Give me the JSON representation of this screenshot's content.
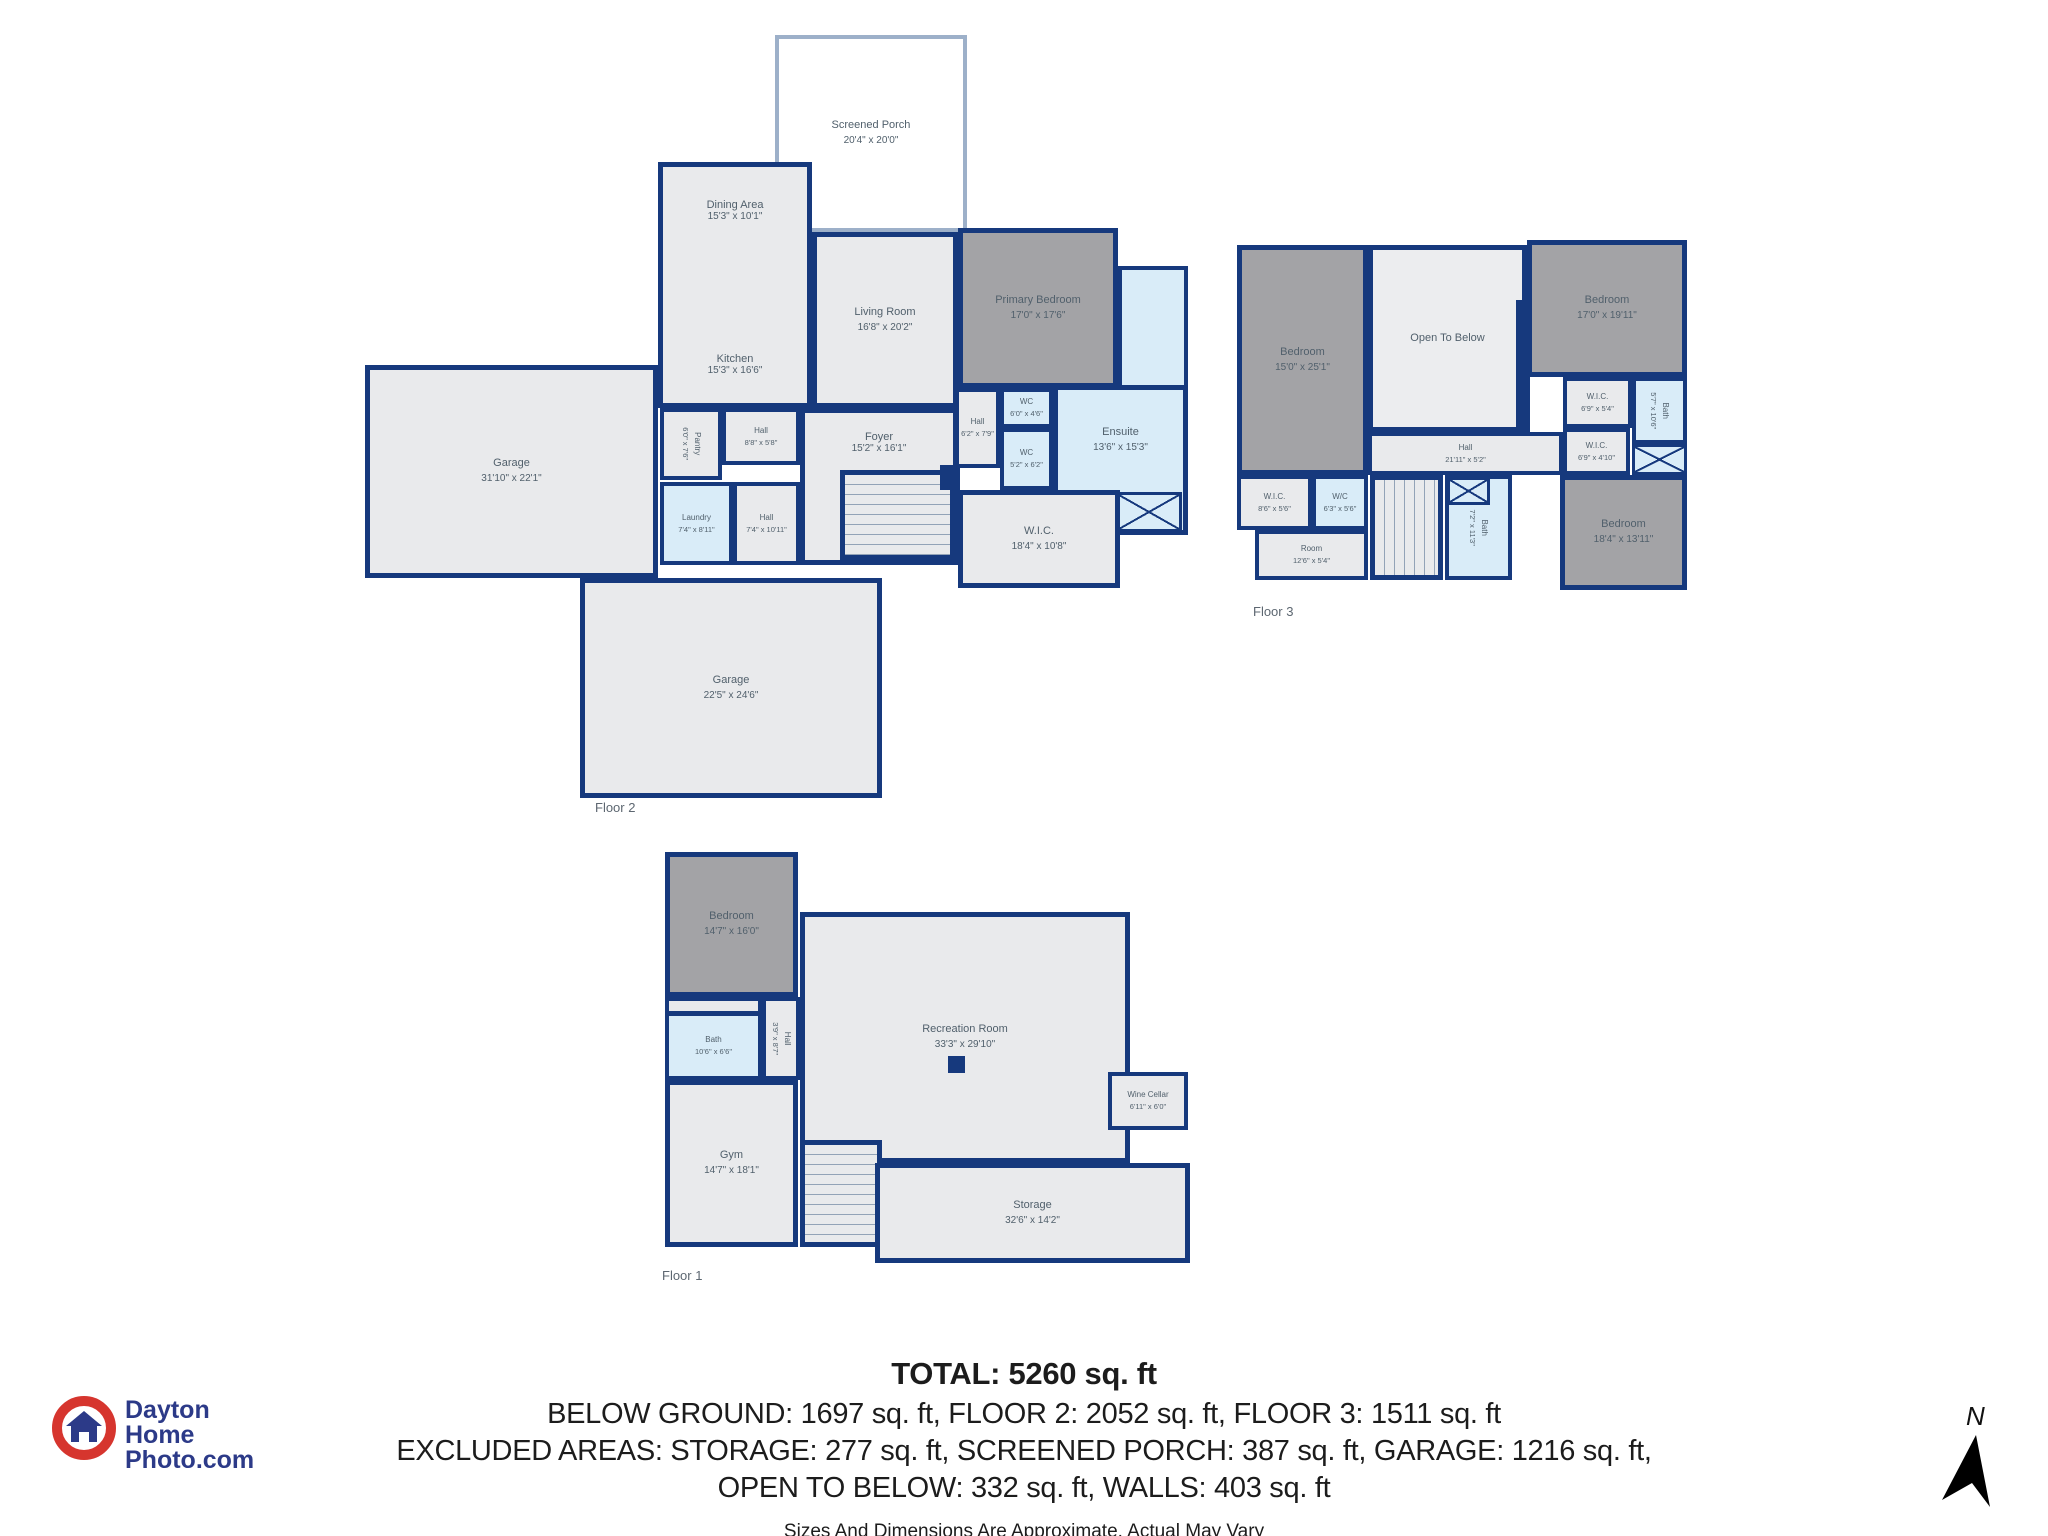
{
  "branding": {
    "line1": "Dayton",
    "line2": "Home",
    "line3": "Photo.com"
  },
  "compass": {
    "label": "N"
  },
  "summary": {
    "total": "TOTAL: 5260 sq. ft",
    "line1": "BELOW GROUND: 1697 sq. ft, FLOOR 2: 2052 sq. ft, FLOOR 3: 1511 sq. ft",
    "line2": "EXCLUDED AREAS: STORAGE: 277 sq. ft, SCREENED PORCH: 387 sq. ft, GARAGE: 1216 sq. ft,",
    "line3": "OPEN TO BELOW: 332 sq. ft, WALLS: 403 sq. ft",
    "disclaimer": "Sizes And Dimensions Are Approximate. Actual May Vary"
  },
  "colors": {
    "wall": "#16397d",
    "room_fill": "#e9eaec",
    "bedroom_fill": "#a3a3a6",
    "wet_room_fill": "#d9ecf8",
    "logo_red": "#d6352e",
    "logo_navy": "#2c3a88"
  },
  "floors": [
    {
      "label": "Floor 2",
      "rooms": [
        {
          "name": "Screened Porch",
          "dims": "20'4\" x 20'0\""
        },
        {
          "name": "Dining Area",
          "dims": "15'3\" x 10'1\""
        },
        {
          "name": "Kitchen",
          "dims": "15'3\" x 16'6\""
        },
        {
          "name": "Living Room",
          "dims": "16'8\" x 20'2\""
        },
        {
          "name": "Primary Bedroom",
          "dims": "17'0\" x 17'6\""
        },
        {
          "name": "WC",
          "dims": "6'0\" x 4'6\""
        },
        {
          "name": "Hall",
          "dims": "6'2\" x 7'9\""
        },
        {
          "name": "WC",
          "dims": "5'2\" x 6'2\""
        },
        {
          "name": "Ensuite",
          "dims": "13'6\" x 15'3\""
        },
        {
          "name": "W.I.C.",
          "dims": "18'4\" x 10'8\""
        },
        {
          "name": "Garage",
          "dims": "31'10\" x 22'1\""
        },
        {
          "name": "Pantry",
          "dims": "6'0\" x 7'6\""
        },
        {
          "name": "Hall",
          "dims": "8'8\" x 5'8\""
        },
        {
          "name": "Foyer",
          "dims": "15'2\" x 16'1\""
        },
        {
          "name": "Laundry",
          "dims": "7'4\" x 8'11\""
        },
        {
          "name": "Hall",
          "dims": "7'4\" x 10'11\""
        },
        {
          "name": "Garage",
          "dims": "22'5\" x 24'6\""
        }
      ]
    },
    {
      "label": "Floor 3",
      "rooms": [
        {
          "name": "Bedroom",
          "dims": "15'0\" x 25'1\""
        },
        {
          "name": "Open To Below",
          "dims": ""
        },
        {
          "name": "Bedroom",
          "dims": "17'0\" x 19'11\""
        },
        {
          "name": "W.I.C.",
          "dims": "6'9\" x 5'4\""
        },
        {
          "name": "Bath",
          "dims": "5'7\" x 10'6\""
        },
        {
          "name": "W.I.C.",
          "dims": "6'9\" x 4'10\""
        },
        {
          "name": "Bedroom",
          "dims": "18'4\" x 13'11\""
        },
        {
          "name": "Hall",
          "dims": "21'11\" x 5'2\""
        },
        {
          "name": "W.I.C.",
          "dims": "8'6\" x 5'6\""
        },
        {
          "name": "W/C",
          "dims": "6'3\" x 5'6\""
        },
        {
          "name": "Room",
          "dims": "12'6\" x 5'4\""
        },
        {
          "name": "Bath",
          "dims": "7'2\" x 11'3\""
        }
      ]
    },
    {
      "label": "Floor 1",
      "rooms": [
        {
          "name": "Bedroom",
          "dims": "14'7\" x 16'0\""
        },
        {
          "name": "Recreation Room",
          "dims": "33'3\" x 29'10\""
        },
        {
          "name": "Bath",
          "dims": "10'6\" x 6'6\""
        },
        {
          "name": "Hall",
          "dims": "3'9\" x 8'7\""
        },
        {
          "name": "Gym",
          "dims": "14'7\" x 18'1\""
        },
        {
          "name": "Wine Cellar",
          "dims": "6'11\" x 6'0\""
        },
        {
          "name": "Storage",
          "dims": "32'6\" x 14'2\""
        }
      ]
    }
  ]
}
